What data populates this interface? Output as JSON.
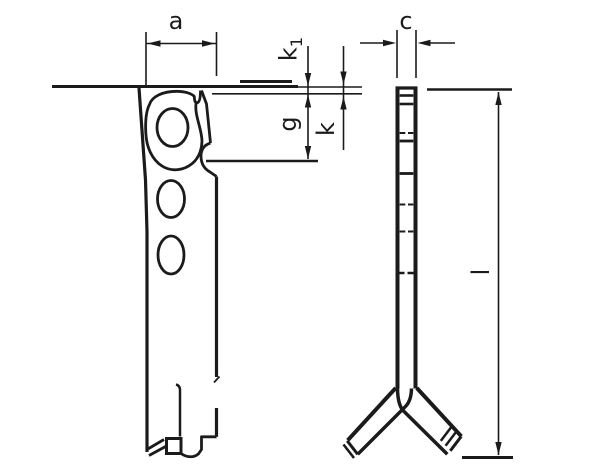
{
  "drawing": {
    "background": "#ffffff",
    "ink": "#1b1b1b",
    "labels": {
      "a": "a",
      "c": "c",
      "k1_base": "k",
      "k1_sub": "1",
      "g": "g",
      "k": "k",
      "l": "l"
    }
  }
}
